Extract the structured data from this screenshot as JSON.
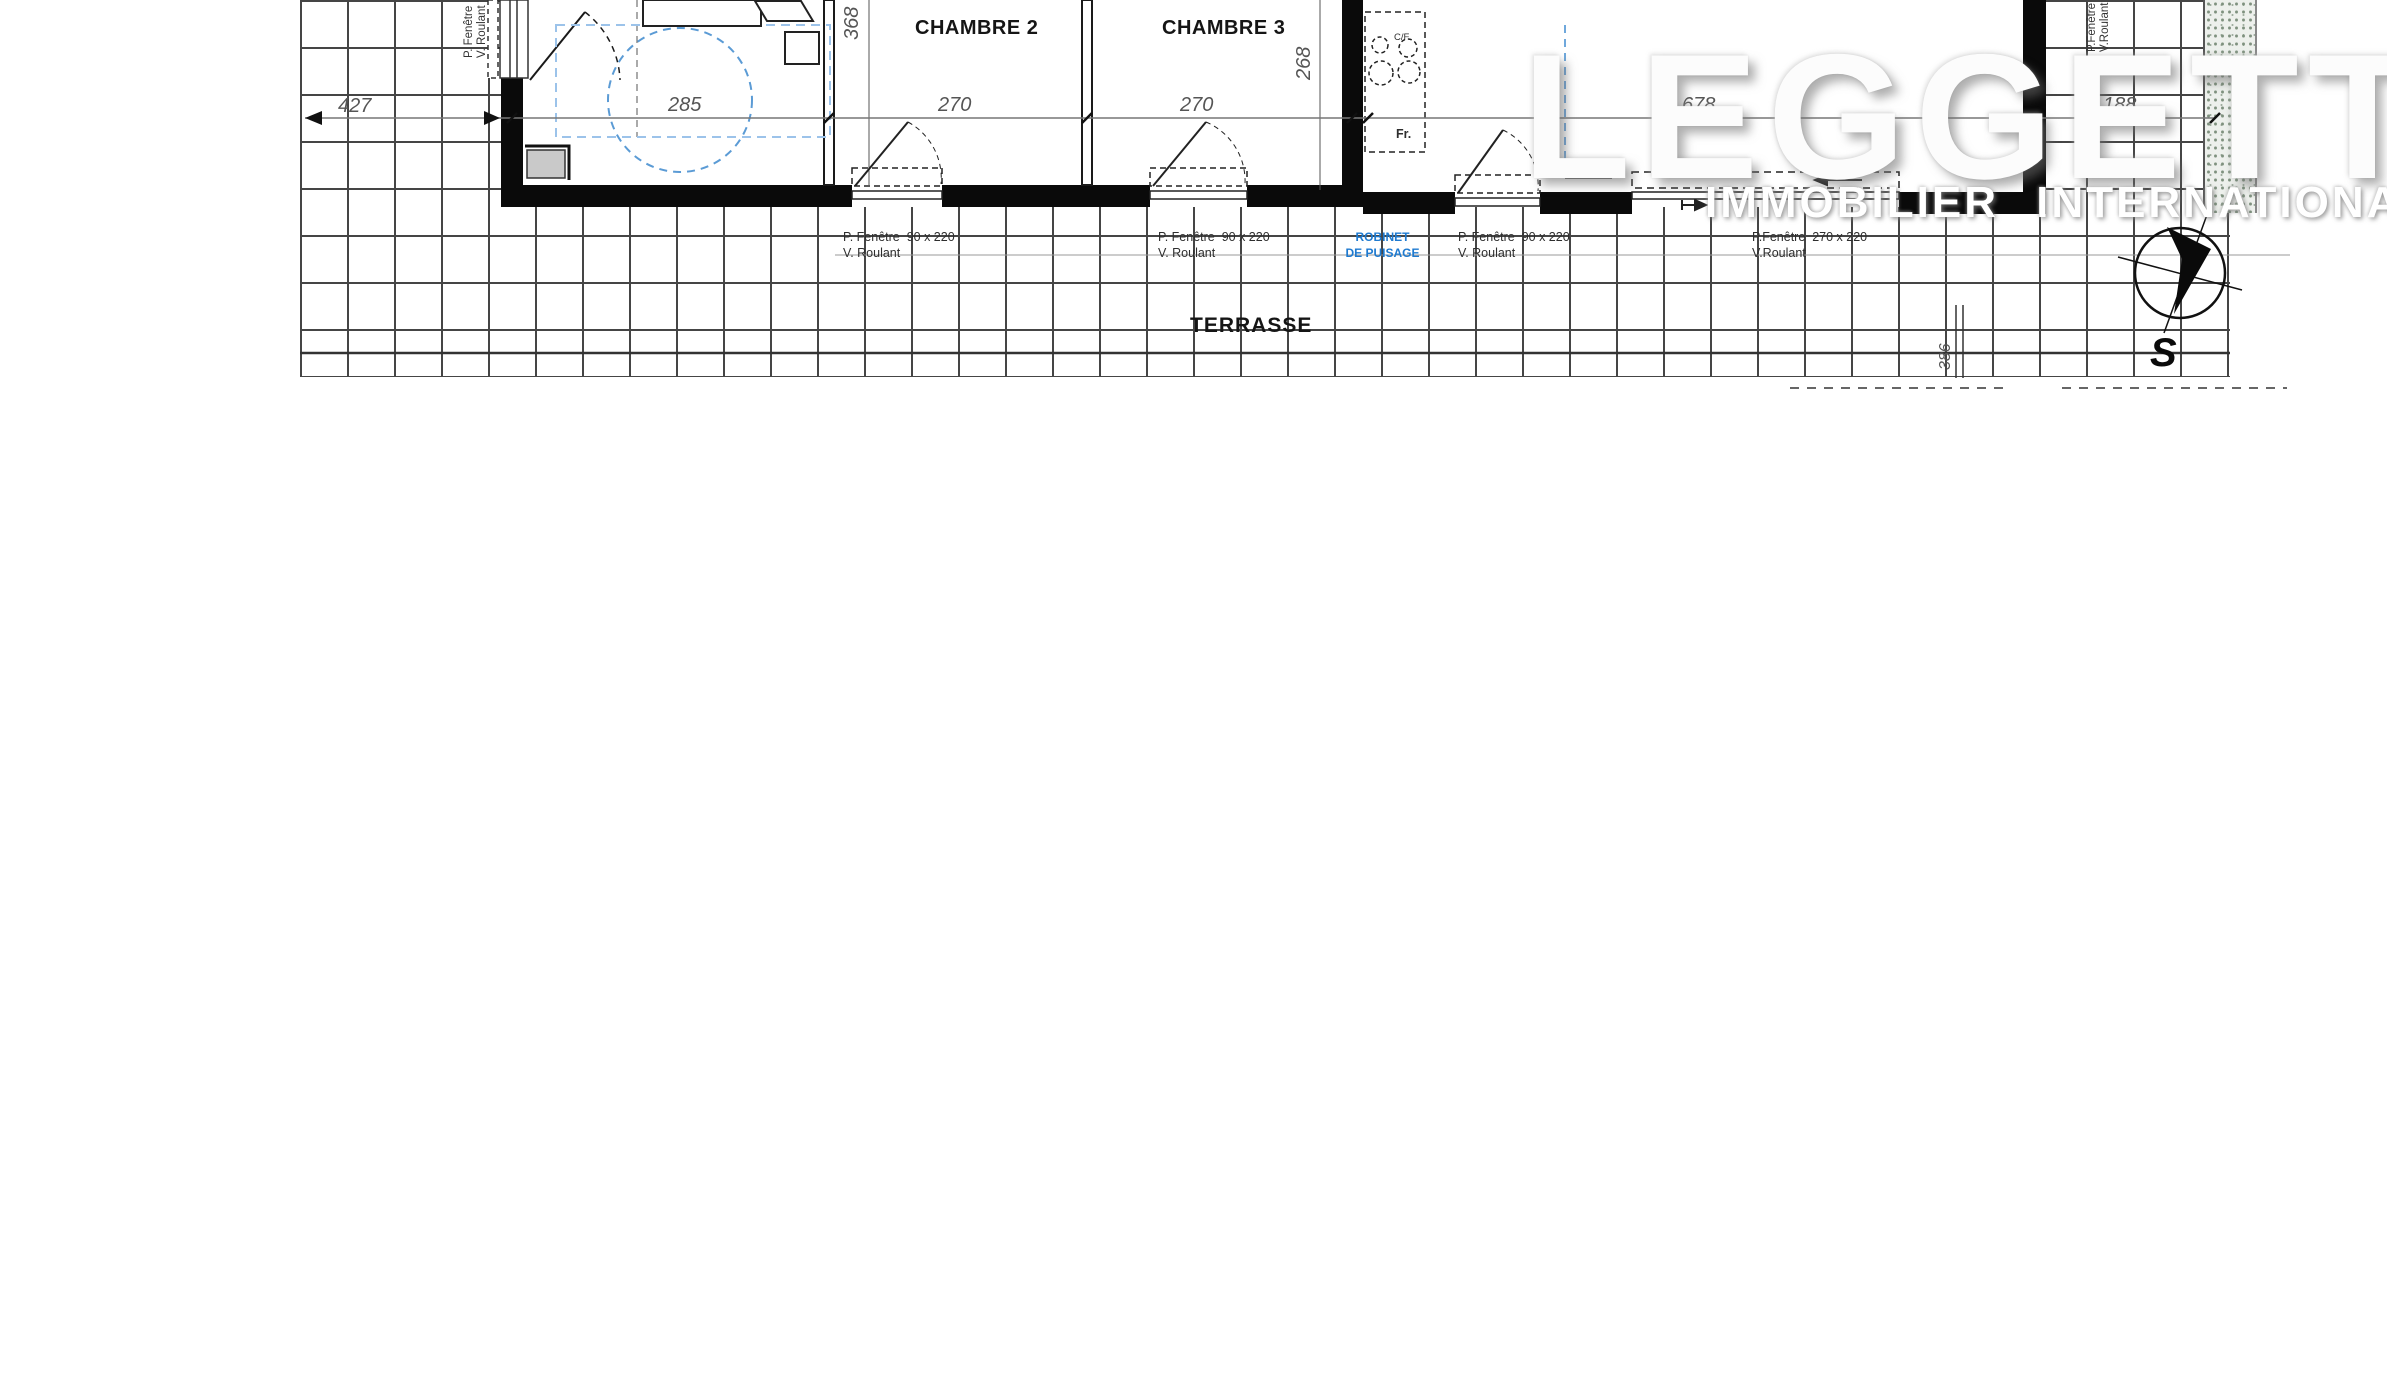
{
  "watermark": {
    "brand": "LEGGETT",
    "tagline": "IMMOBILIER  INTERNATIONAL"
  },
  "rooms": {
    "bedroom2": "CHAMBRE 2",
    "bedroom3": "CHAMBRE 3",
    "terrace": "TERRASSE"
  },
  "labels": {
    "window_w2": {
      "l1": "P. Fenêtre  90 x 220",
      "l2": "V. Roulant"
    },
    "window_w3": {
      "l1": "P. Fenêtre  90 x 220",
      "l2": "V. Roulant"
    },
    "window_w4": {
      "l1": "P. Fenêtre  90 x 220",
      "l2": "V. Roulant"
    },
    "window_bay": {
      "l1": "P.Fenêtre  270 x 220",
      "l2": "V.Roulant"
    },
    "west_window": {
      "l1": "P. Fenêtre",
      "l2": "V. Roulant"
    },
    "east_window": {
      "l1": "P.Fenêtre",
      "l2": "V.Roulant"
    },
    "tap": {
      "l1": "ROBINET",
      "l2": "DE PUISAGE"
    },
    "fridge": "Fr.",
    "hob": "C/F"
  },
  "dimensions": {
    "d427": "427",
    "d285": "285",
    "d270a": "270",
    "d270b": "270",
    "d268": "268",
    "d368": "368",
    "d678": "678",
    "d188": "188",
    "d386": "386"
  },
  "compass": {
    "south": "S"
  },
  "colors": {
    "accent_blue": "#1e7ad0",
    "dash_blue": "#5b9bd5",
    "grid_line": "#454545",
    "wall": "#0a0a0a",
    "speckle": "#8fa18f"
  }
}
